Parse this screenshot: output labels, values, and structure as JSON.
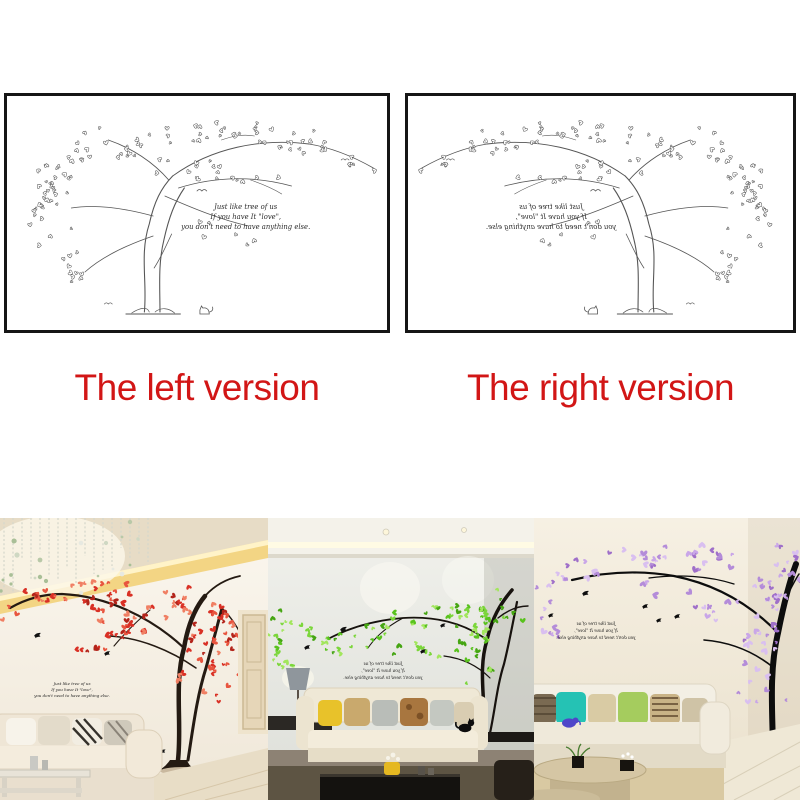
{
  "captions": {
    "left": "The left version",
    "right": "The right version",
    "color": "#d21616"
  },
  "decal_quote": {
    "line1": "Just like tree of us",
    "line2": "If you have It \"love\",",
    "line3": "you don't need to have anything else."
  },
  "diagram": {
    "line_color": "#555555"
  },
  "photos": [
    {
      "name": "red-tree-room-photo",
      "leaf_colors": [
        "#d93025",
        "#e8553f",
        "#b3241a",
        "#f07f63"
      ],
      "branch_color": "#241a12"
    },
    {
      "name": "green-tree-room-photo",
      "leaf_colors": [
        "#58c21d",
        "#7bd63a",
        "#a2e65c",
        "#45a512"
      ],
      "branch_color": "#17120e"
    },
    {
      "name": "purple-tree-room-photo",
      "leaf_colors": [
        "#b48cd9",
        "#c9a6e8",
        "#9f6fc9",
        "#d9bff0"
      ],
      "branch_color": "#0d0d0d"
    }
  ]
}
